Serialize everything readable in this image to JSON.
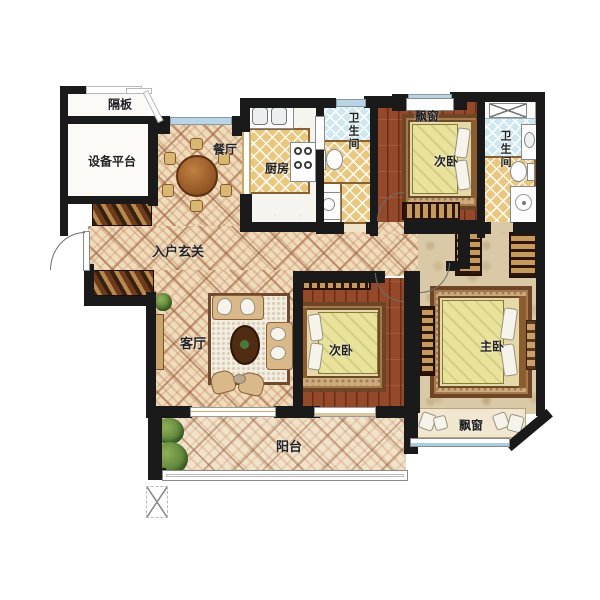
{
  "rooms": {
    "partition": "隔板",
    "equipment_platform": "设备平台",
    "dining": "餐厅",
    "kitchen": "厨房",
    "bath_top": "卫生间",
    "bay_window_top": "飘窗",
    "bedroom_top": "次卧",
    "bath_right": "卫生间",
    "foyer": "入户玄关",
    "living": "客厅",
    "bedroom_middle": "次卧",
    "master_bedroom": "主卧",
    "bay_window_bottom": "飘窗",
    "balcony": "阳台"
  },
  "colors": {
    "wall": "#1a1a1a",
    "tile_floor": "#eedcba",
    "wood_floor": "#94492a",
    "kitchen_tile": "#e7c87e",
    "bath_blue_tile": "#cfe7ee",
    "bath_gold_tile": "#e5c987",
    "master_floor": "#d9c9a6",
    "window_glass": "#b9d4e4",
    "bed_blanket": "#e9e29b"
  }
}
